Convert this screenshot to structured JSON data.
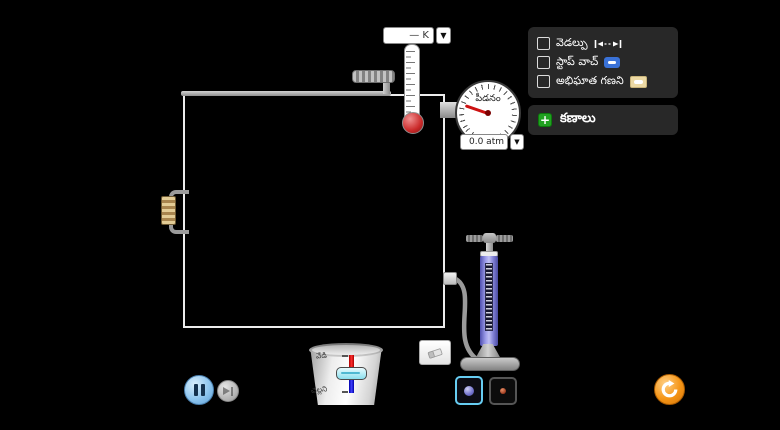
{
  "controls_panel": {
    "items": [
      {
        "label": "వెడల్పు",
        "icon": "width-icon",
        "checked": false
      },
      {
        "label": "స్టాప్ వాచ్",
        "icon": "stopwatch-icon",
        "checked": false
      },
      {
        "label": "అభిఘాత గణని",
        "icon": "collision-counter-icon",
        "checked": false
      }
    ]
  },
  "particles_panel": {
    "label": "కణాలు",
    "plus": "+"
  },
  "thermometer": {
    "readout": "— K",
    "dropdown": "▼"
  },
  "pressure_gauge": {
    "label": "పీడనం",
    "readout": "0.0 atm",
    "dropdown": "▼"
  },
  "heater": {
    "heat_label": "వేడి",
    "cool_label": "చల్లని"
  },
  "colors": {
    "background": "#000000",
    "panel_bg": "#282828",
    "selected_border": "#67cdf2",
    "reset_orange": "#f59516",
    "needle_red": "#cc1111",
    "stopwatch_icon": "#3a72d8",
    "collision_counter_icon": "#ecd9a4",
    "pump_body": "#8a8ae0",
    "heavy_particle": "#7878d2",
    "light_particle": "#a03c20",
    "pause_button": "#8ec6f0",
    "heater_hot_track": "#ff3030",
    "heater_cold_track": "#4040ff"
  }
}
